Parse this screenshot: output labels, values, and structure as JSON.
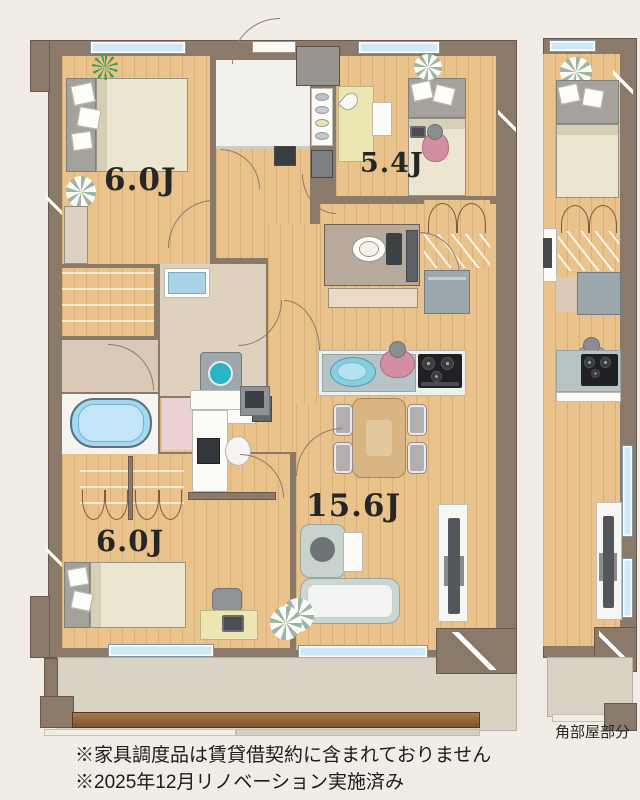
{
  "plan_type": "apartment-floor-plan",
  "rooms": [
    {
      "id": "bedroom-northwest",
      "label": "6.0J"
    },
    {
      "id": "bedroom-northeast",
      "label": "5.4J"
    },
    {
      "id": "living-dining-kitchen",
      "label": "15.6J"
    },
    {
      "id": "bedroom-southwest",
      "label": "6.0J"
    }
  ],
  "corner_section_label": "角部屋部分",
  "notes": {
    "line1": "※家具調度品は賃貸借契約に含まれておりません",
    "line2": "※2025年12月リノベーション実施済み"
  },
  "colors": {
    "bg": "#f2ece6",
    "wall": "#8b7969",
    "wood": "#e9c28c",
    "window_glass": "#cfeaf4",
    "bathtub": "#a3d8f2",
    "balcony": "#d9d3c5",
    "sofa": "#ccd6d1",
    "dining_table": "#d9b584",
    "desk": "#ece7b2",
    "stove": "#202124",
    "washer_teal": "#2ab5c6",
    "person": "#d28fa3",
    "plant_green": "#3f9d4f",
    "plant_sage": "#9cb6a4",
    "text": "#1c1c1c"
  }
}
